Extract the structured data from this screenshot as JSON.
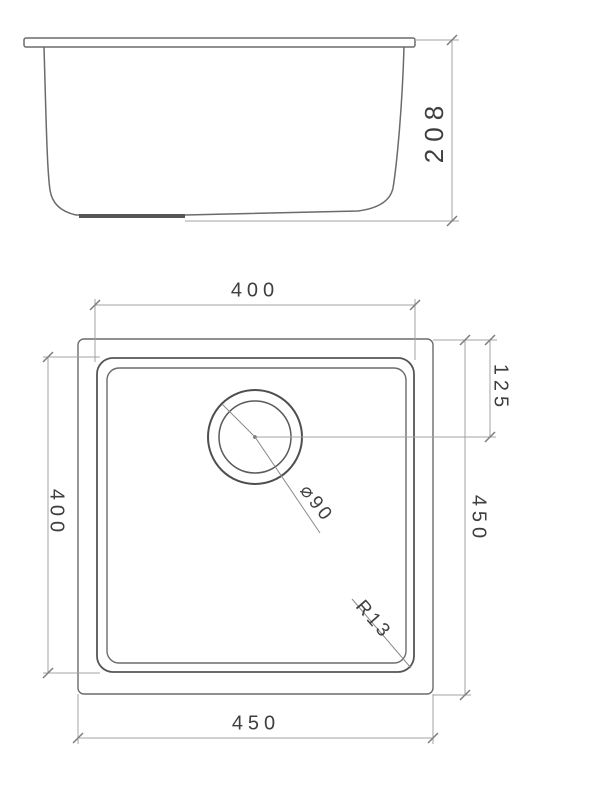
{
  "side_view": {
    "height_label": "208"
  },
  "plan_view": {
    "bowl_width_label": "400",
    "bowl_length_label": "400",
    "overall_length_label": "450",
    "overall_width_label": "450",
    "drain_offset_label": "125",
    "drain_diameter_label": "⌀90",
    "corner_radius_label": "R13"
  }
}
